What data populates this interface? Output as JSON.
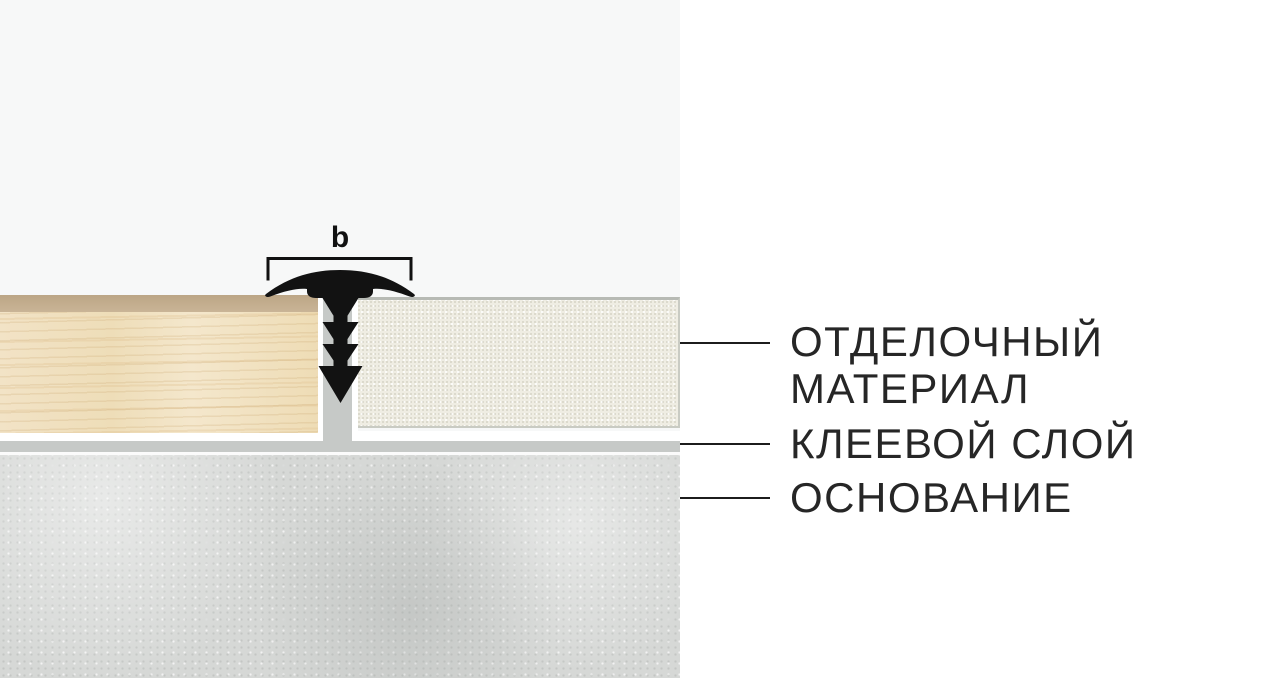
{
  "diagram": {
    "dimension_label": "b",
    "callouts": {
      "finishing_material": {
        "line1": "ОТДЕЛОЧНЫЙ",
        "line2": "МАТЕРИАЛ"
      },
      "adhesive_layer": "КЛЕЕВОЙ СЛОЙ",
      "substrate": "ОСНОВАНИЕ"
    }
  },
  "colors": {
    "canvas-bg": "#f7f8f8",
    "panel-bg": "#ffffff",
    "profile-black": "#121212",
    "leader-line": "#1c1c1c",
    "label-text": "#262626",
    "wood-base": "#f1e1c0",
    "wood-edge": "#bca686",
    "tile-base": "#efede3",
    "adhesive-gray": "#c6c9c7",
    "concrete-gray": "#d6d8d6"
  }
}
